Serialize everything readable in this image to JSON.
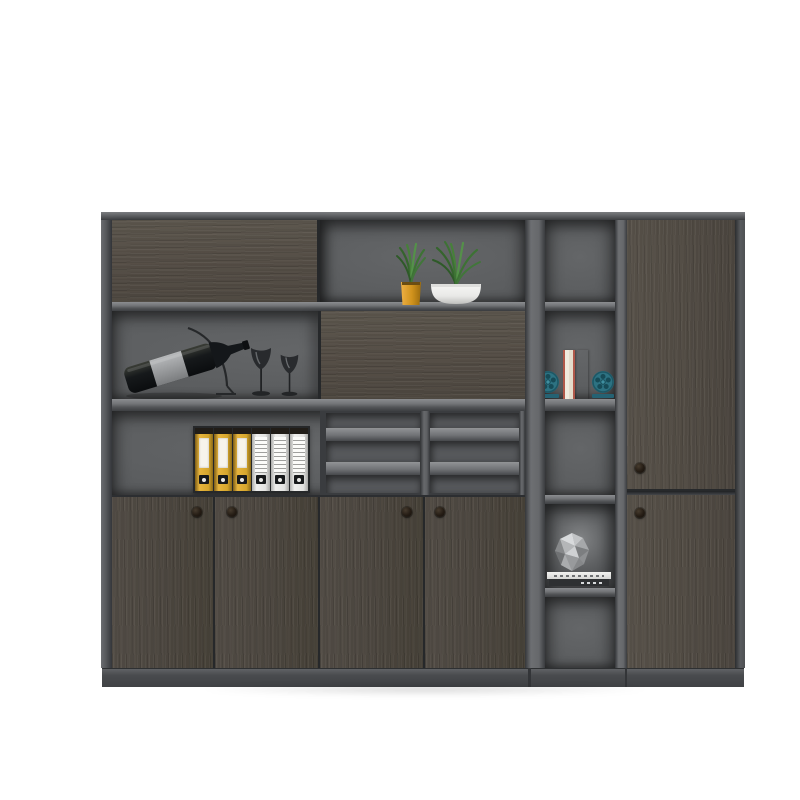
{
  "scene": {
    "type": "product-photo",
    "subject": "Dark grey wood modular office bookcase filing cabinet with open display shelves",
    "background_color": "#ffffff",
    "palette": {
      "frame_gray": "#56585b",
      "shelf_face_light": "#7e8083",
      "interior_gray": "#5b5d5f",
      "wood_dark": "#554f47",
      "wood_streak": "#635c52",
      "plinth_gray": "#484a4d",
      "knob_black": "#1f1913",
      "pot_yellow": "#d99a22",
      "pot_white": "#f1f1ef",
      "plant_green": "#47803a",
      "binder_yellow": "#d9a830",
      "binder_white": "#e8e8e6",
      "bookend_teal": "#2d7282",
      "book_cream": "#e6ddc9",
      "gem_gray": "#aaacae"
    },
    "units": {
      "left": {
        "row1": [
          "closed horizontal-grain wood door",
          "open shelf with two potted grass plants"
        ],
        "row2": [
          "open shelf with reclining wine bottle on wire stand and two wine glasses",
          "sliding horizontal-grain wood panel"
        ],
        "row3": [
          "shelf holding three yellow and three white lever-arch binders",
          "six-slot letter tray grid"
        ],
        "bottom": "four vertical-grain wood doors with round knobs"
      },
      "middle": {
        "compartments": [
          "empty",
          "two books between teal film-reel bookends",
          "empty",
          "faceted stone ornament on two stacked books",
          "empty"
        ]
      },
      "right": {
        "doors": [
          "tall upper wood door with knob",
          "lower wood door with knob"
        ]
      }
    },
    "counts": {
      "yellow_binders": 3,
      "white_binders": 3,
      "left_door_knobs": 4,
      "right_door_knobs": 2,
      "plants": 2,
      "wine_glasses": 2,
      "tray_slots": 6,
      "middle_compartments": 5
    },
    "labels": {
      "cabinet": "office bookcase cabinet",
      "wine_bottle": "wine bottle on display stand",
      "wine_glasses": "two wine glasses",
      "plant_yellow": "grass plant in yellow pot",
      "plant_white": "grass plant in white pot",
      "binders": "row of lever-arch file binders",
      "tray_grid": "paper tray compartments",
      "bookends": "books with teal reel bookends",
      "ornament": "faceted stone ornament on stacked books"
    }
  }
}
